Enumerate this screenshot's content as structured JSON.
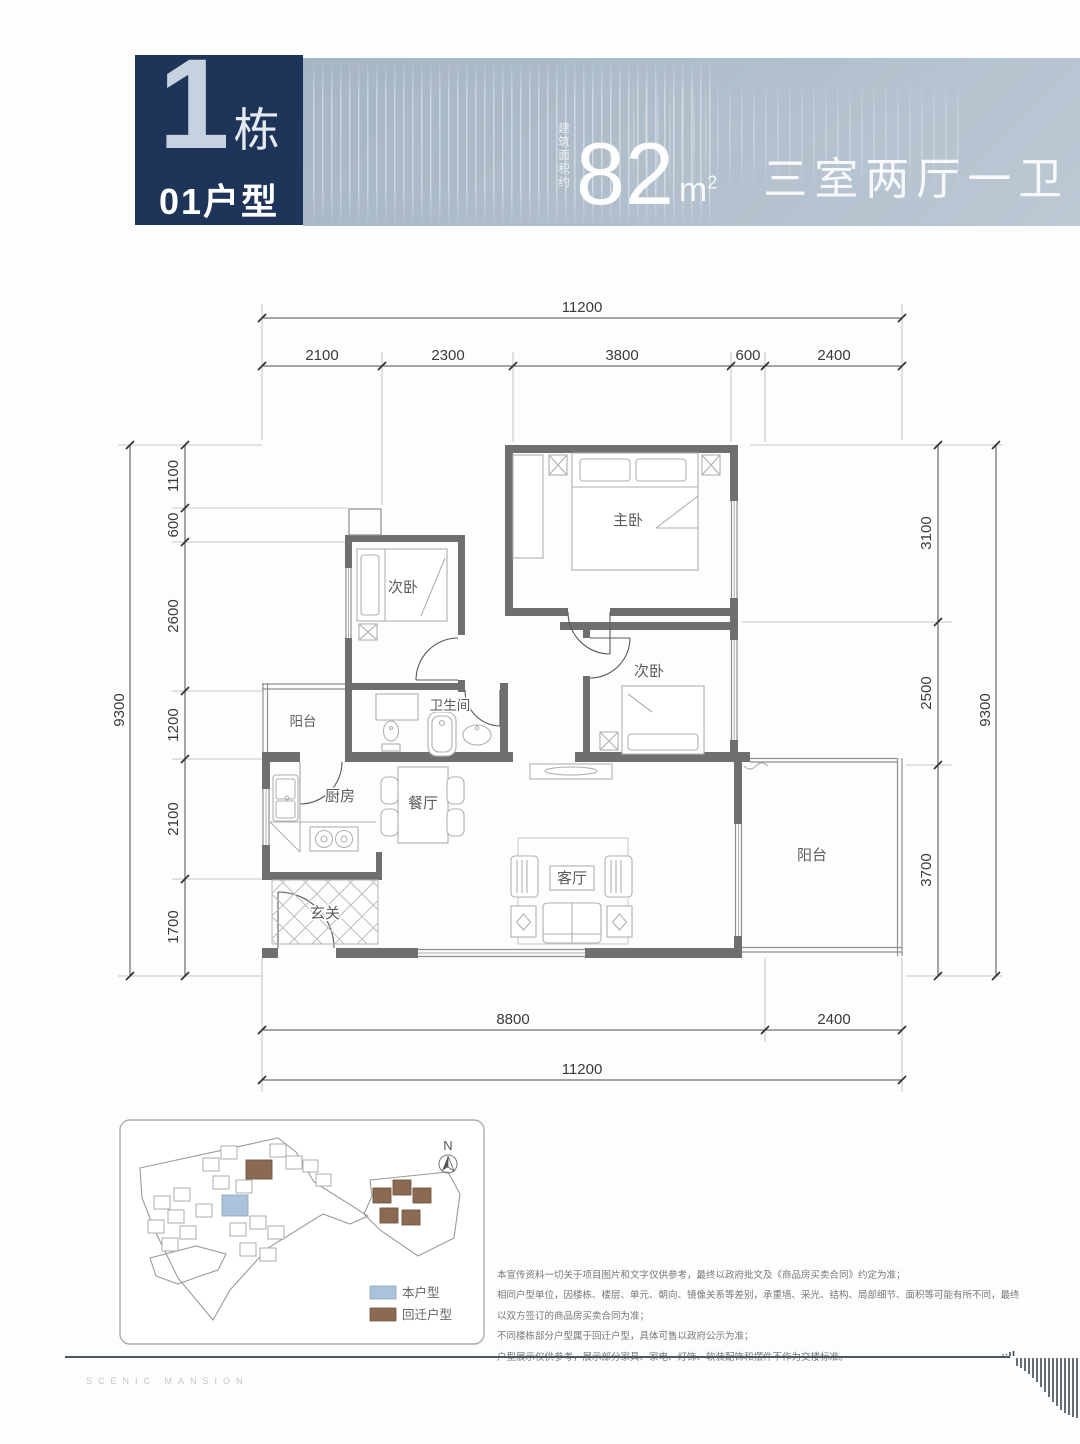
{
  "header": {
    "block_number": "1",
    "block_suffix": "栋",
    "unit_label": "01户型",
    "area_prefix": "建筑面积约",
    "area_value": "82",
    "area_unit": "m",
    "area_unit_sup": "2",
    "spec": "三室两厅一卫",
    "colors": {
      "badge_bg": "#1f3459",
      "banner_bg": "#b2c0cd",
      "text": "#ffffff"
    }
  },
  "floorplan": {
    "dims": {
      "top_total": "11200",
      "top_segments": [
        "2100",
        "2300",
        "3800",
        "600",
        "2400"
      ],
      "left_total": "9300",
      "left_segments": [
        "1100",
        "600",
        "2600",
        "1200",
        "2100",
        "1700"
      ],
      "right_total": "9300",
      "right_segments": [
        "3100",
        "2500",
        "3700"
      ],
      "bottom_segments": [
        "8800",
        "2400"
      ],
      "bottom_total": "11200"
    },
    "rooms": {
      "master": "主卧",
      "bedroom2": "次卧",
      "bedroom3": "次卧",
      "bath": "卫生间",
      "balcony_left": "阳台",
      "kitchen": "厨房",
      "dining": "餐厅",
      "foyer": "玄关",
      "living": "客厅",
      "balcony_right": "阳台"
    }
  },
  "siteplan": {
    "north_label": "N",
    "legend": [
      {
        "label": "本户型",
        "color": "#a9c3da"
      },
      {
        "label": "回迁户型",
        "color": "#8a6a52"
      }
    ]
  },
  "disclaimer": {
    "lines": [
      "本宣传资料一切关于项目图片和文字仅供参考，最终以政府批文及《商品房买卖合同》约定为准；",
      "相同户型单位，因楼栋、楼层、单元、朝向、镜像关系等差别，承重墙、采光、结构、局部细节、面积等可能有所不同，最终以双方签订的商品房买卖合同为准；",
      "不同楼栋部分户型属于回迁户型，具体可售以政府公示为准；",
      "户型展示仅供参考，展示部分家具、家电、灯饰、软装配饰和摆件不作为交楼标准。"
    ]
  },
  "footer": {
    "brand": "SCENIC MANSION"
  }
}
